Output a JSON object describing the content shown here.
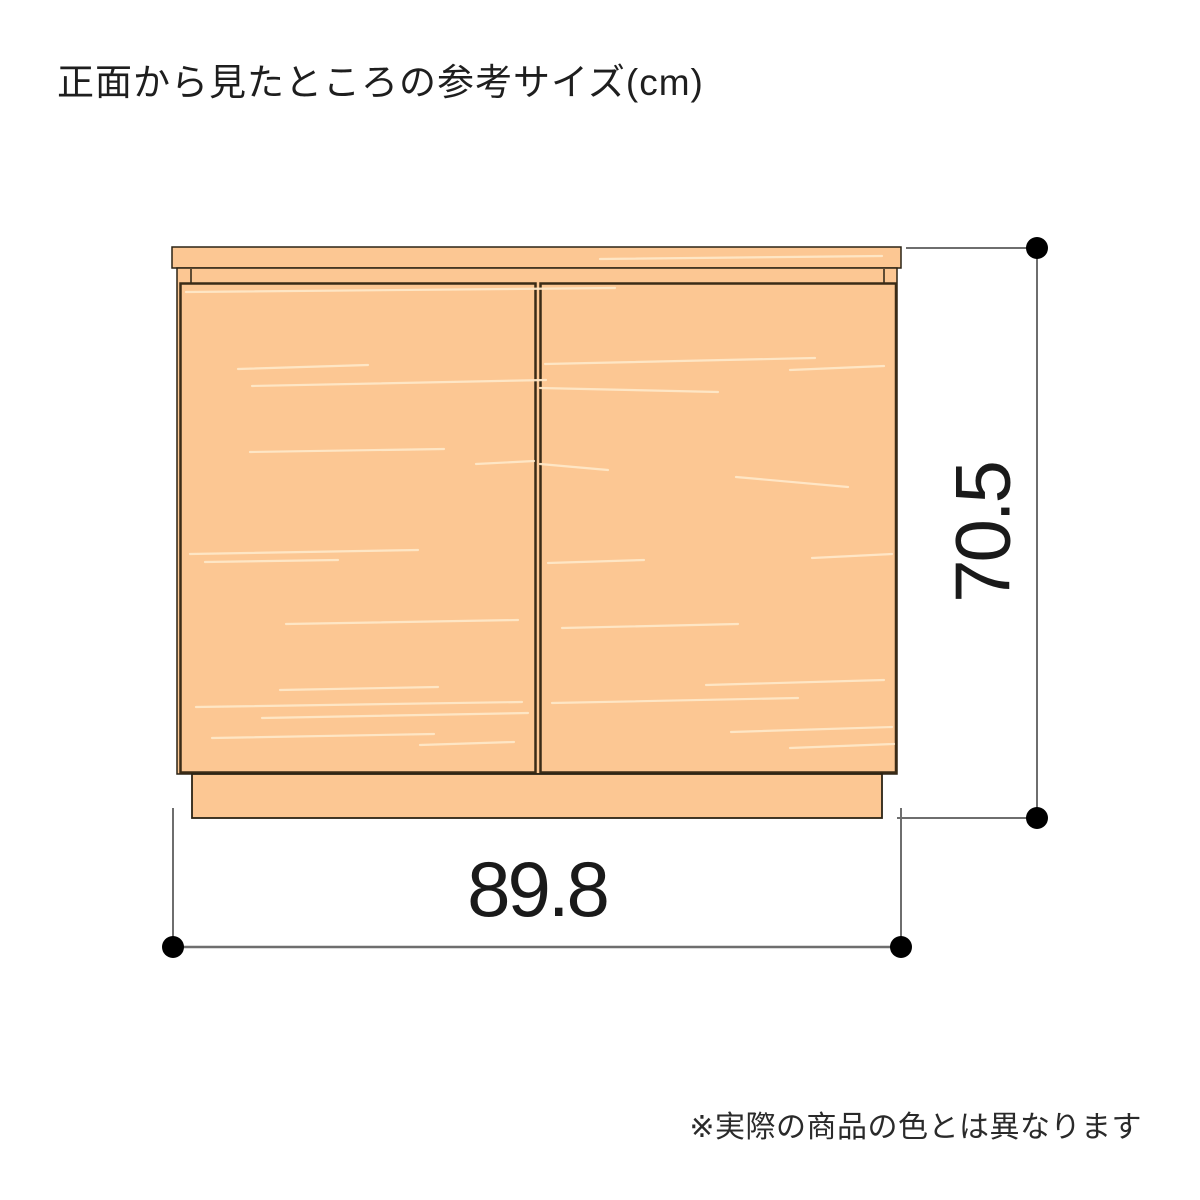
{
  "title": "正面から見たところの参考サイズ(cm)",
  "unit": "cm",
  "dimensions": {
    "width_label": "89.8",
    "height_label": "70.5"
  },
  "footnote": "※実際の商品の色とは異なります",
  "colors": {
    "wood_fill": "#FCC793",
    "wood_grain": "#FFE8C8",
    "cabinet_outline": "#2B2315",
    "door_outline": "#3A2B16",
    "dimension_line": "#6E6E6E",
    "dimension_dot": "#000000",
    "label_text": "#1A1A1A"
  }
}
